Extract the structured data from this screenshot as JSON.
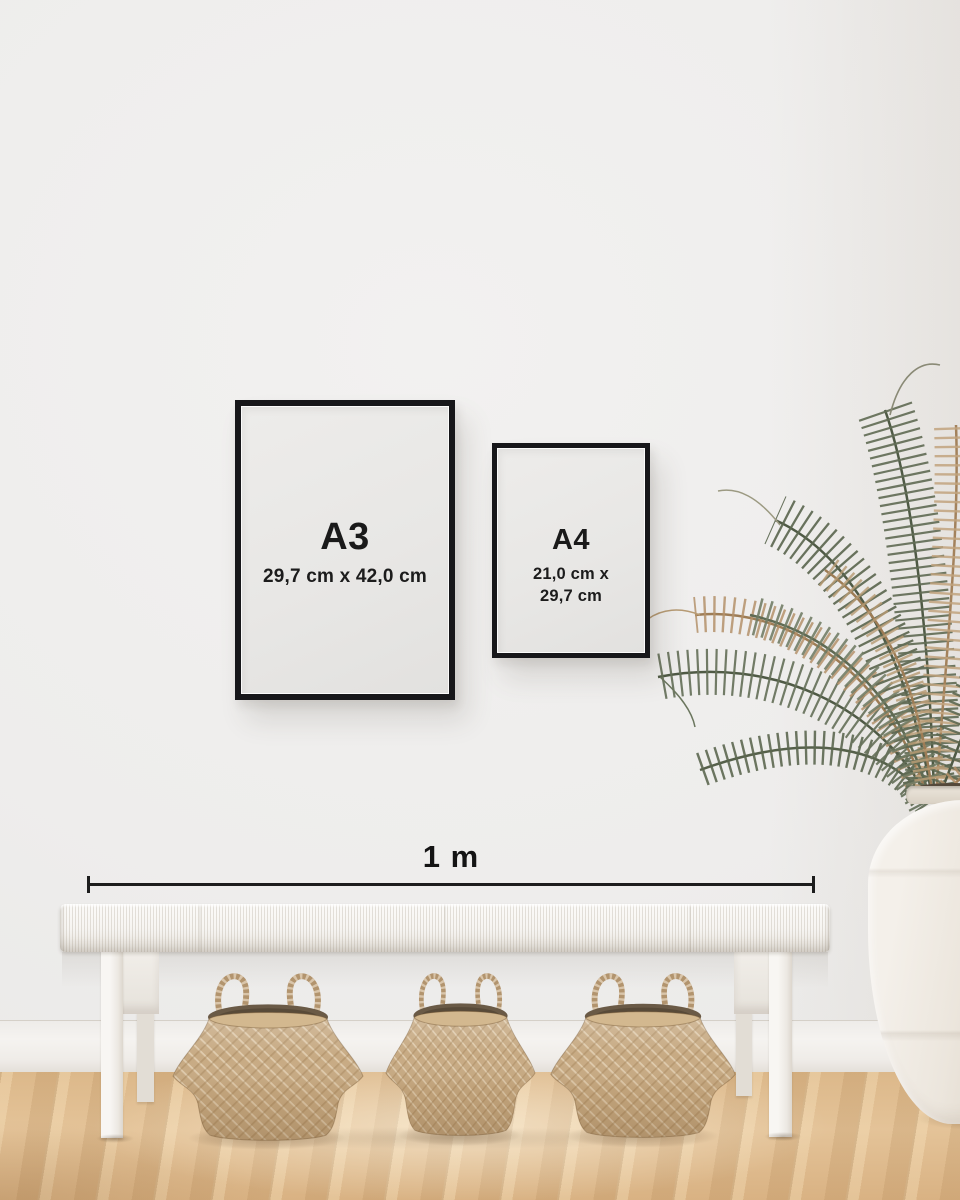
{
  "frames": {
    "a3": {
      "label": "A3",
      "dims": "29,7 cm x 42,0 cm"
    },
    "a4": {
      "label": "A4",
      "dims_line1": "21,0 cm x",
      "dims_line2": "29,7 cm"
    }
  },
  "measure": {
    "label": "1 m"
  },
  "scene": {
    "objects": [
      "a3-frame",
      "a4-frame",
      "scale-bar",
      "bench",
      "seagrass-basket-left",
      "seagrass-basket-middle",
      "seagrass-basket-right",
      "palm-plant",
      "ceramic-vase",
      "wood-floor",
      "baseboard",
      "wall"
    ],
    "colors": {
      "wall": "#efeeed",
      "frame_border": "#17171a",
      "paper": "#e9e8e6",
      "text": "#1a1a1a",
      "floor_light": "#e9cfa3",
      "floor_mid": "#dcb88a",
      "floor_dark": "#c29a66",
      "basket": "#c7aa83",
      "bench": "#f6f4f1",
      "plant_green": "#5c6750",
      "plant_tan": "#b4916a",
      "vase": "#ece6dd"
    }
  }
}
